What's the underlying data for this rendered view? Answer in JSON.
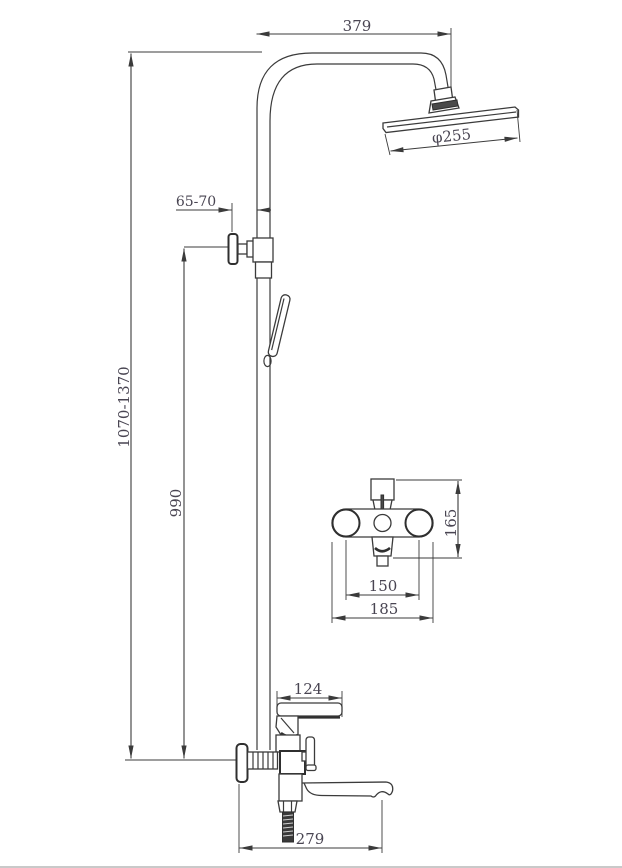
{
  "page": {
    "background": "#ffffff",
    "border_color": "#c9c9c9"
  },
  "drawing": {
    "type": "technical-dimension-drawing",
    "subject": "wall-mounted shower column with rain head, hand shower and bath spout mixer",
    "units_implied": "mm",
    "line_color": "#3b3b3b",
    "label_color": "#494552",
    "dimensions": {
      "arm_reach": "379",
      "head_diameter": "φ255",
      "wall_offset": "65-70",
      "overall_height": "1070-1370",
      "riser_height": "990",
      "mixer_body_height": "165",
      "mixer_hole_spacing": "150",
      "mixer_overall_width": "185",
      "handle_length": "124",
      "spout_reach": "279"
    }
  }
}
